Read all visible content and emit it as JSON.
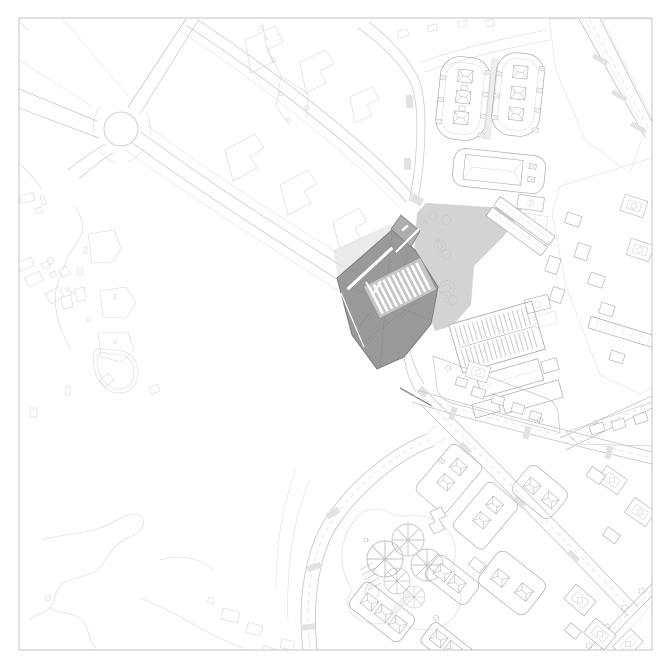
{
  "colors": {
    "paper": "#ffffff",
    "ink_faint": "#d7d7d7",
    "ink_light": "#c3c3c3",
    "ink_mid": "#a7a7a7",
    "ink_dark": "#8c8c8c",
    "roof_dark": "#9b9b9b",
    "roof_edge": "#7e7e7e",
    "roof_ribbed": "#c5c5c5",
    "roof_annex": "#aeaeae",
    "plaza": "#d3d3d3",
    "street_tint": "#e2e2e2"
  },
  "features": [
    "drawing-border",
    "west-open-land",
    "roundabout-junction",
    "northwest-road-network",
    "vacant-blocks-north",
    "northeast-housing-blocks",
    "east-dense-district",
    "public-plaza",
    "plaza-trees",
    "plaza-bar-building",
    "project-building",
    "school-campus",
    "east-avenues",
    "center-south-blocks",
    "ring-road",
    "circular-pavilions",
    "south-housing-rows",
    "southeast-courtyard-blocks",
    "southwest-coast-paths"
  ]
}
